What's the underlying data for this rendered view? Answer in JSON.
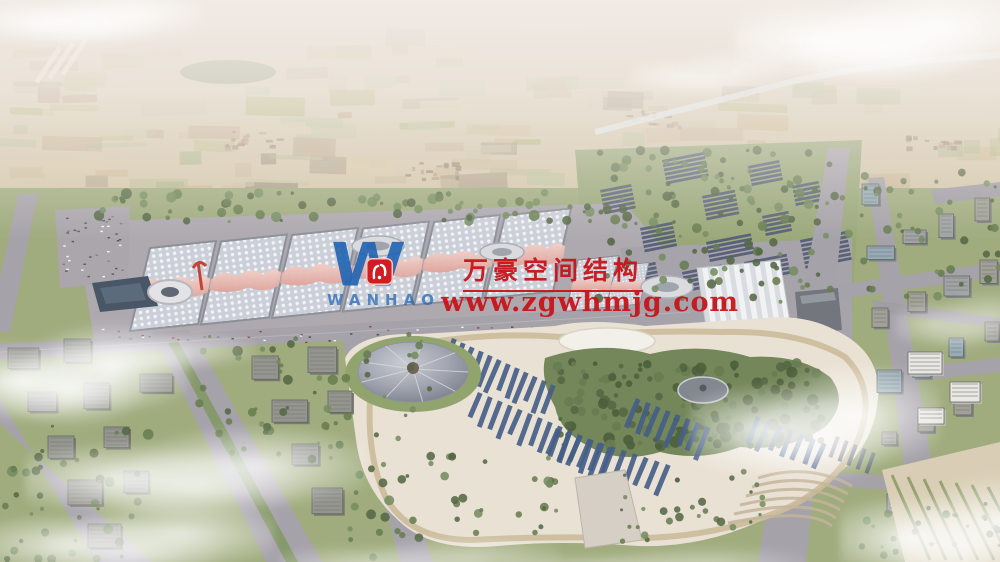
{
  "watermark": {
    "logo_letter": "W",
    "logo_subtext": "WANHAO",
    "title": "万豪空间结构",
    "url": "www.zgwhmjg.com",
    "red": "#c6141a",
    "blue": "#1e61b2",
    "emblem_red": "#cf1d22"
  },
  "palette": {
    "haze": "#f1ebe7",
    "farmland_base": "#d3c6a8",
    "field_tones": [
      "#b9c195",
      "#d8c8a3",
      "#b59a7b",
      "#a7b383",
      "#c3ad89",
      "#9d9178",
      "#cbbf9f",
      "#adb06f",
      "#c9b184"
    ],
    "forest": "#5d7247",
    "tree_dark": "#4a5e3a",
    "tree_mid": "#5d7547",
    "tree_light": "#6c8656",
    "grass": "#9aa877",
    "lawn": "#8aa065",
    "road": "#a19ea6",
    "road_dark": "#8f8c95",
    "apron": "#a8a5ac",
    "hall_roof": "#c9ced8",
    "hall_dot": "#f4f6f9",
    "hall_gap": "#868a94",
    "canopy_pink": "#e3aca2",
    "canopy_pink_light": "#f2cfc6",
    "pleated_light": "#f2f4f6",
    "pleated_dark": "#cfd4da",
    "solar_panel": "#47536e",
    "park_ground": "#e9e1d2",
    "park_path": "#c9b996",
    "pond_dark": "#3d4c5c",
    "panel_blue": "#3a5580",
    "cone_light": "#b6bac4",
    "cone_dark": "#777c8a",
    "building_top": "#8f9089",
    "building_side": "#696a64",
    "white_building": "#e9e9e6",
    "canal": "#dfe9eb",
    "runway": "#ece5dc"
  }
}
